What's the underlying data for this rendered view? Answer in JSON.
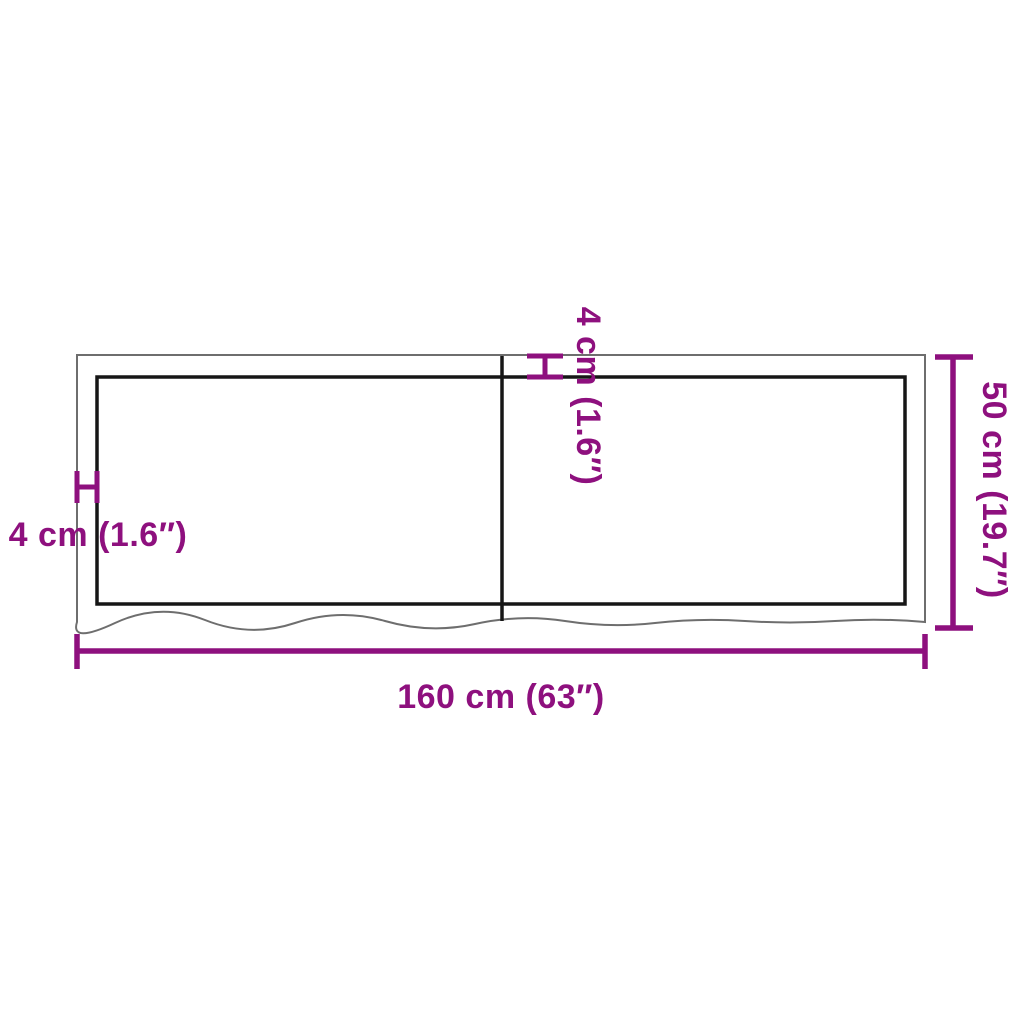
{
  "page": {
    "background": "#ffffff",
    "description": "Product dimension diagram of a rectangular two-panel board (table top / wall shelf) with live wavy bottom edge"
  },
  "colors": {
    "dimension_purple": "#8E107E",
    "edge_dark": "#161616",
    "edge_light": "#6e6e6e"
  },
  "dimensions": {
    "width_label": "160 cm (63″)",
    "height_label": "50 cm (19.7″)",
    "thickness_left_label": "4 cm (1.6″)",
    "thickness_top_label": "4 cm (1.6″)"
  }
}
